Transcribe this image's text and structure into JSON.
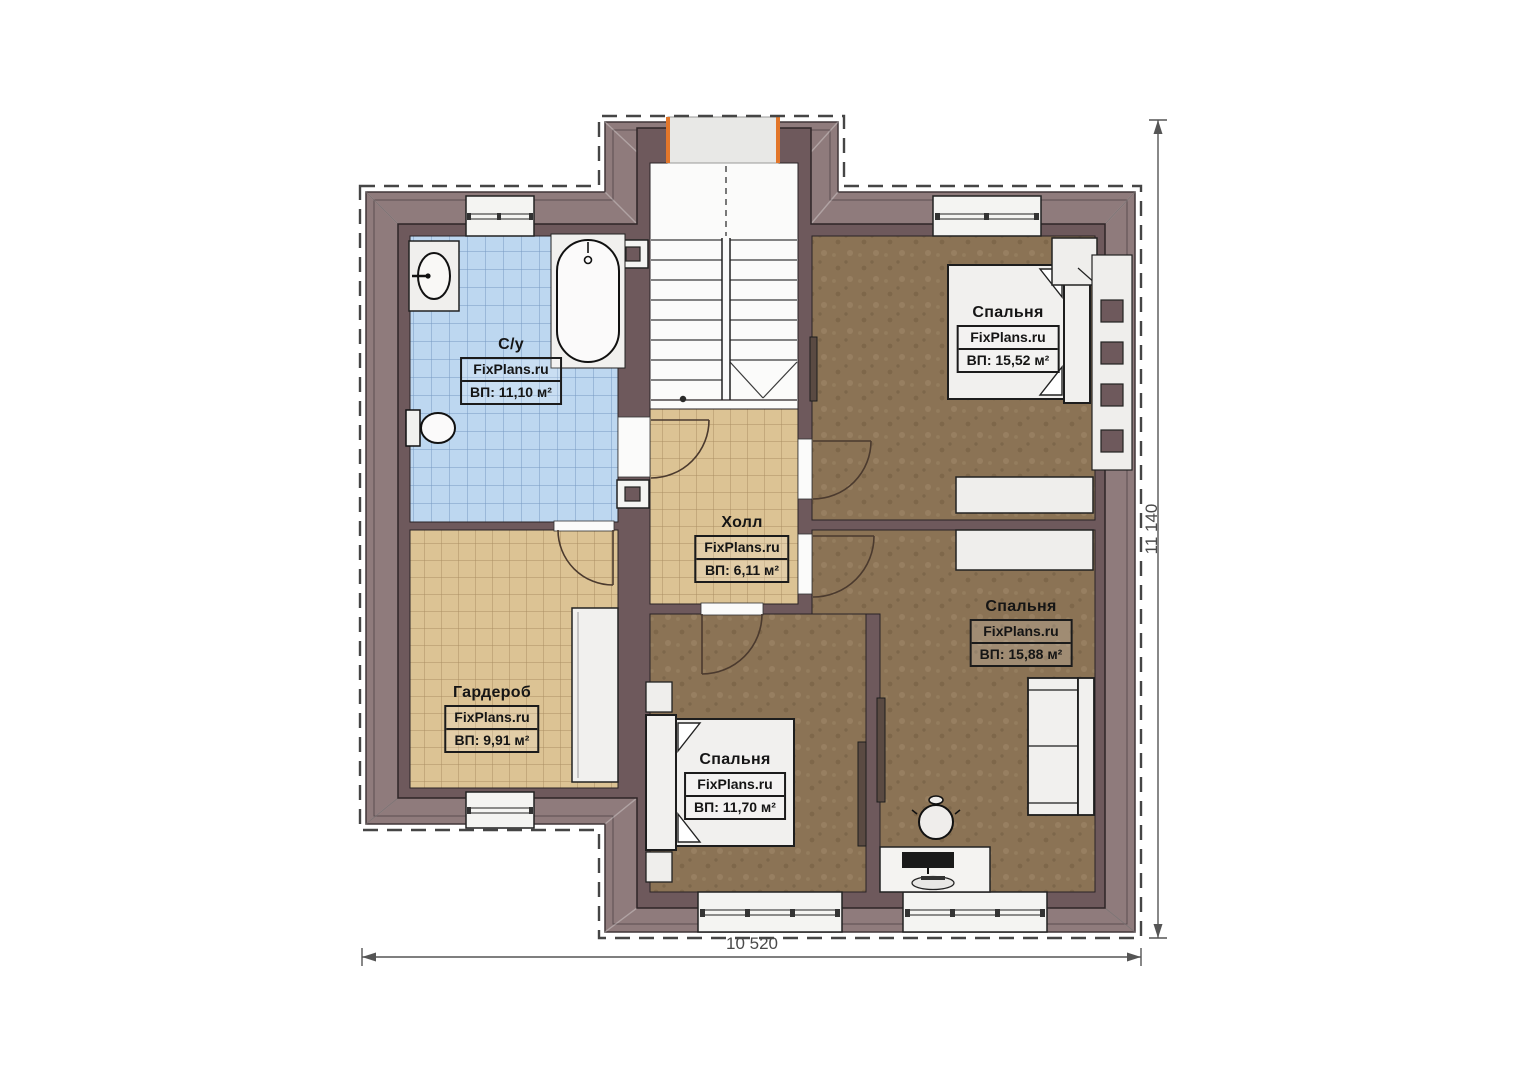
{
  "plan": {
    "title": "Floor plan — second floor",
    "watermark": "FixPlans.ru",
    "dimensions": {
      "width": "10 520",
      "height": "11 140"
    },
    "rooms": [
      {
        "id": "bathroom",
        "name": "С/у",
        "area": "ВП: 11,10 м²"
      },
      {
        "id": "hall",
        "name": "Холл",
        "area": "ВП: 6,11 м²"
      },
      {
        "id": "bedroom-top",
        "name": "Спальня",
        "area": "ВП: 15,52 м²"
      },
      {
        "id": "bedroom-right",
        "name": "Спальня",
        "area": "ВП: 15,88 м²"
      },
      {
        "id": "bedroom-bottom",
        "name": "Спальня",
        "area": "ВП: 11,70 м²"
      },
      {
        "id": "wardrobe",
        "name": "Гардероб",
        "area": "ВП: 9,91 м²"
      }
    ],
    "colors": {
      "roof_band": "#8f7b7c",
      "wall": "#6e595c",
      "bathroom_floor": "#bdd7f0",
      "hall_floor": "#dcc394",
      "bedroom_floor": "#8b7355",
      "accent_orange": "#e2762a",
      "furniture": "#f0efed"
    }
  }
}
